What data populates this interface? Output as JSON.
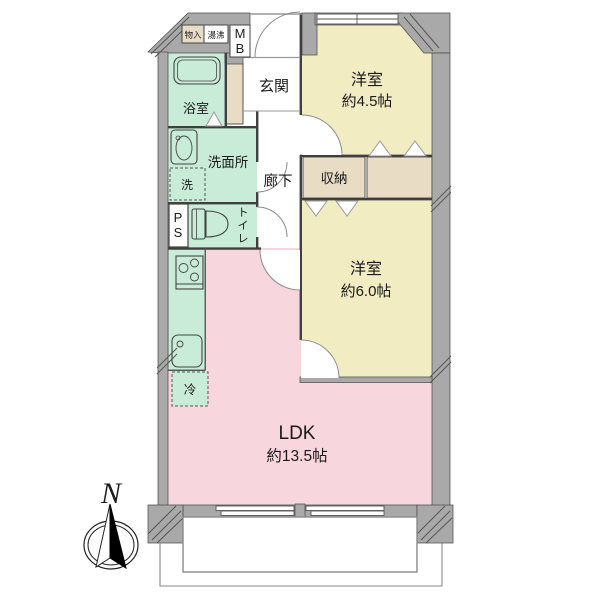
{
  "floorplan": {
    "compass": {
      "label": "N"
    },
    "rooms": {
      "western1": {
        "label": "洋室",
        "area": "約4.5帖"
      },
      "western2": {
        "label": "洋室",
        "area": "約6.0帖"
      },
      "ldk": {
        "label": "LDK",
        "area": "約13.5帖"
      },
      "entrance": {
        "label": "玄関"
      },
      "bathroom": {
        "label": "浴室"
      },
      "washroom": {
        "label": "洗面所"
      },
      "corridor": {
        "label": "廊下"
      },
      "closet": {
        "label": "収納"
      },
      "toilet": {
        "label": "トイレ",
        "chars": [
          "ト",
          "イ",
          "レ"
        ]
      }
    },
    "fixtures": {
      "storage": "物入",
      "water_heater": "湯沸",
      "meter_box": {
        "label": "MB",
        "chars": [
          "M",
          "B"
        ]
      },
      "pipe_space": {
        "label": "PS",
        "chars": [
          "P",
          "S"
        ]
      },
      "washer": "洗",
      "fridge": "冷"
    },
    "colors": {
      "wall": "#a9a9a9",
      "tatami_room": "#f2ecc3",
      "ldk": "#f8d6dd",
      "wet_area": "#c9ecd9",
      "storage": "#e9dcc4",
      "line": "#3f3f3f"
    }
  }
}
